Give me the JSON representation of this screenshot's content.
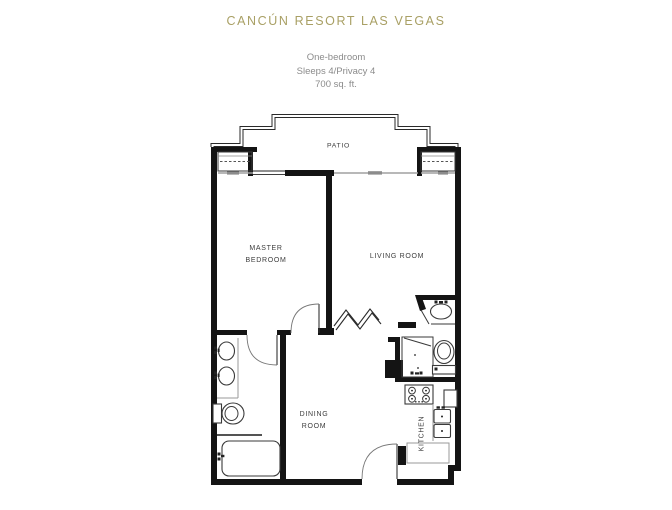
{
  "header": {
    "title": "CANCÚN RESORT LAS VEGAS",
    "subtitle_line1": "One-bedroom",
    "subtitle_line2": "Sleeps 4/Privacy 4",
    "subtitle_line3": "700 sq. ft."
  },
  "rooms": {
    "patio": "PATIO",
    "master_line1": "MASTER",
    "master_line2": "BEDROOM",
    "living": "LIVING ROOM",
    "dining_line1": "DINING",
    "dining_line2": "ROOM",
    "kitchen": "KITCHEN"
  },
  "colors": {
    "title": "#a9a065",
    "subtitle": "#8b8b8b",
    "wall": "#141414",
    "fixture": "#3a3a3a",
    "slider": "#a0a0a0",
    "label": "#3d3d3d"
  }
}
